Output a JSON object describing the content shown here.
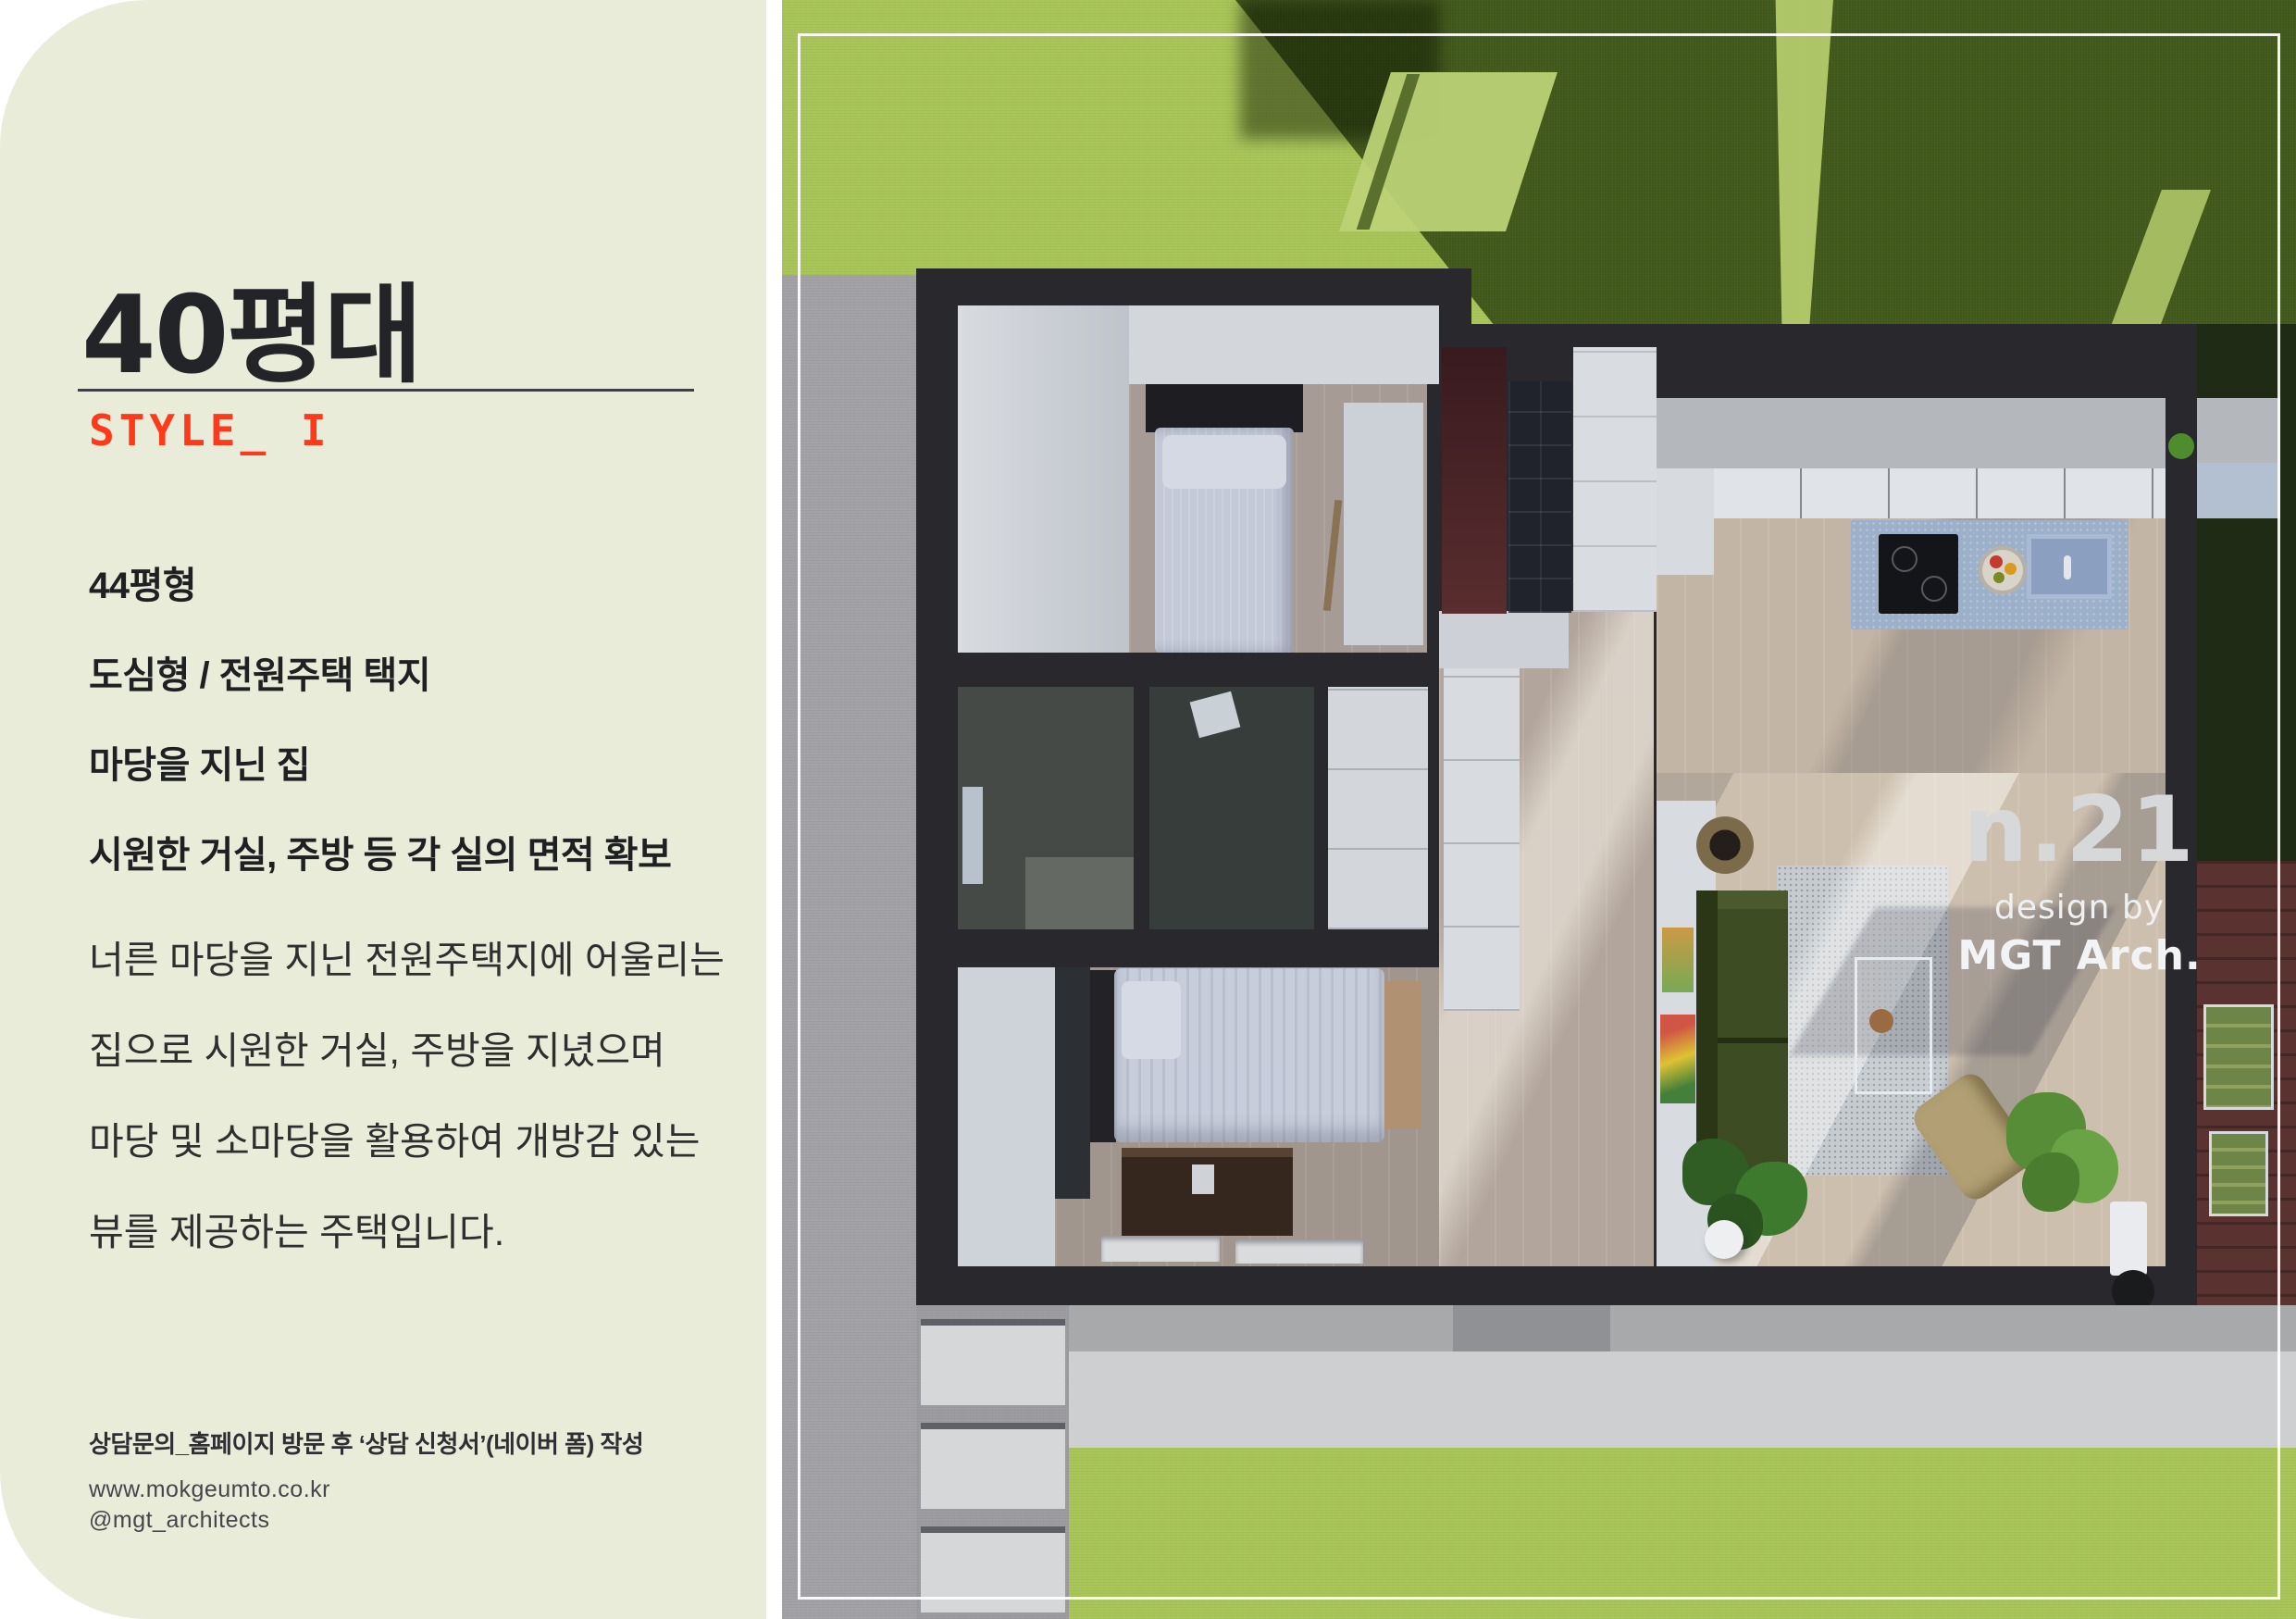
{
  "page": {
    "background": "#ffffff"
  },
  "panel": {
    "title": "40평대",
    "style_label": "STYLE_ I",
    "features": [
      "44평형",
      "도심형 / 전원주택 택지",
      "마당을 지닌 집",
      "시원한 거실, 주방 등 각 실의 면적 확보"
    ],
    "description_lines": [
      "너른 마당을 지닌 전원주택지에 어울리는",
      "집으로 시원한 거실, 주방을 지녔으며",
      "마당 및 소마당을 활용하여 개방감 있는",
      "뷰를 제공하는 주택입니다."
    ],
    "footer": {
      "contact": "상담문의_홈페이지 방문 후 ‘상담 신청서’(네이버 폼) 작성",
      "website": "www.mokgeumto.co.kr",
      "instagram": "@mgt_architects"
    }
  },
  "photo": {
    "badge": {
      "number": "n.21",
      "byline": "design by",
      "studio": "MGT Arch."
    }
  },
  "colors": {
    "panel_bg": "#e9ecd9",
    "accent": "#ff3a1b",
    "title_text": "#222428",
    "grass_light": "#a8c558",
    "grass_dark": "#42591c",
    "concrete": "#a2a1a5",
    "house_wall": "#29292d",
    "island_blue": "#9cb0c9",
    "sofa_green": "#3e4c24",
    "deck_brown": "#5a3330",
    "badge_text": "#d7d8da"
  }
}
